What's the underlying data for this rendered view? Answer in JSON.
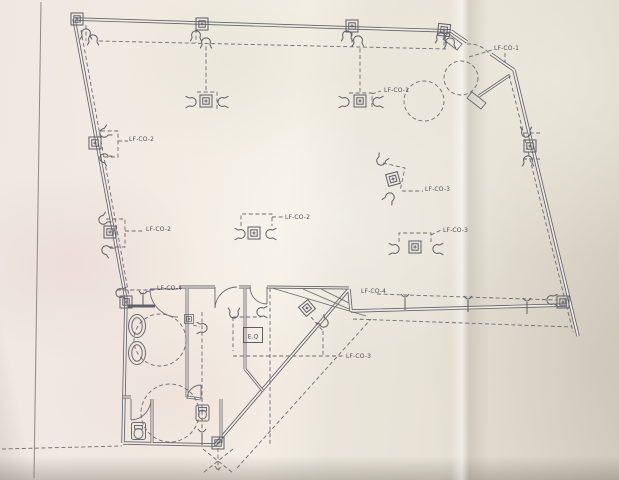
{
  "document_type": "scanned-floor-plan-drawing",
  "drawing": {
    "labels": {
      "lfco1_top": "LF-CO-1",
      "lfco1_mid": "LF-CO-1",
      "lfco2_upper": "LF-CO-2",
      "lfco2_lower": "LF-CO-2",
      "lfco2_center": "LF-CO-2",
      "lfco3_tilted": "LF-CO-3",
      "lfco3_right": "LF-CO-3",
      "lfco3_lower": "LF-CO-3",
      "lfco4_bath": "LF-CO-4",
      "lfco4_run": "LF-CO-4",
      "eq_box": "E.Q"
    },
    "symbols": {
      "junction_box": "junction-box-icon",
      "hook": "conduit-hook-icon",
      "pendant": "pendant-drop-icon",
      "toilet": "toilet-icon",
      "sink": "sink-icon",
      "door_swing": "door-swing-arc",
      "turning_circle": "dashed-turning-circle"
    },
    "colors": {
      "paper_warm": "#f5f0e6",
      "paper_pink": "#efe0dd",
      "paper_shaded": "#e0dbce",
      "pencil_line": "#61616a",
      "label_text": "#4e4e57"
    }
  }
}
